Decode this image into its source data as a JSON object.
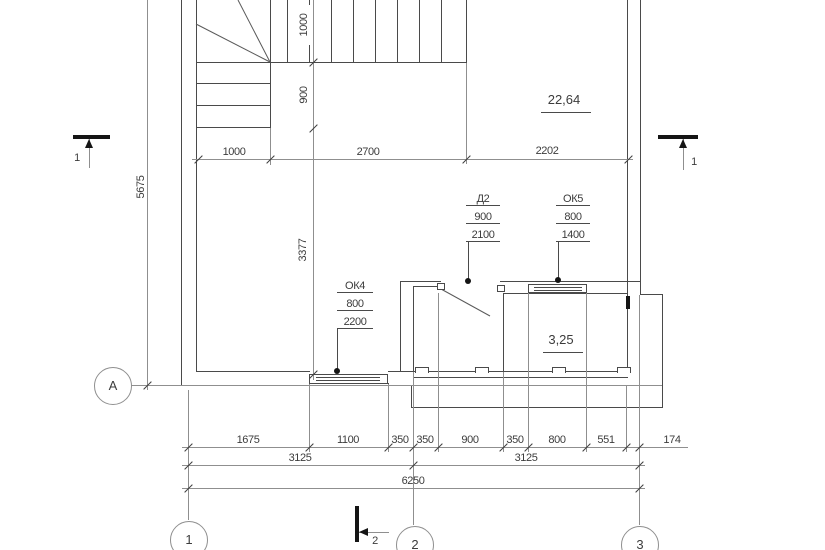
{
  "plan": {
    "rooms": {
      "living_area": "22,64",
      "balcony_area": "3,25"
    },
    "openings": {
      "ok4": {
        "mark": "ОК4",
        "dim1": "800",
        "dim2": "2200"
      },
      "ok5": {
        "mark": "ОК5",
        "dim1": "800",
        "dim2": "1400"
      },
      "d2": {
        "mark": "Д2",
        "dim1": "900",
        "dim2": "2100"
      }
    },
    "axes": {
      "a1": "1",
      "a2": "2",
      "a3": "3",
      "aA": "А"
    },
    "sections": {
      "left": "1",
      "right": "1",
      "bottom": "2"
    },
    "dims": {
      "top": {
        "d1": "1000",
        "d2": "2700",
        "d3": "2202"
      },
      "stair": {
        "d1": "1000",
        "d2": "900",
        "d3": "3377"
      },
      "left": "5675",
      "row1": [
        "1675",
        "1100",
        "350",
        "350",
        "900",
        "350",
        "800",
        "551",
        "174"
      ],
      "row2": [
        "3125",
        "3125"
      ],
      "row3": "6250"
    }
  }
}
